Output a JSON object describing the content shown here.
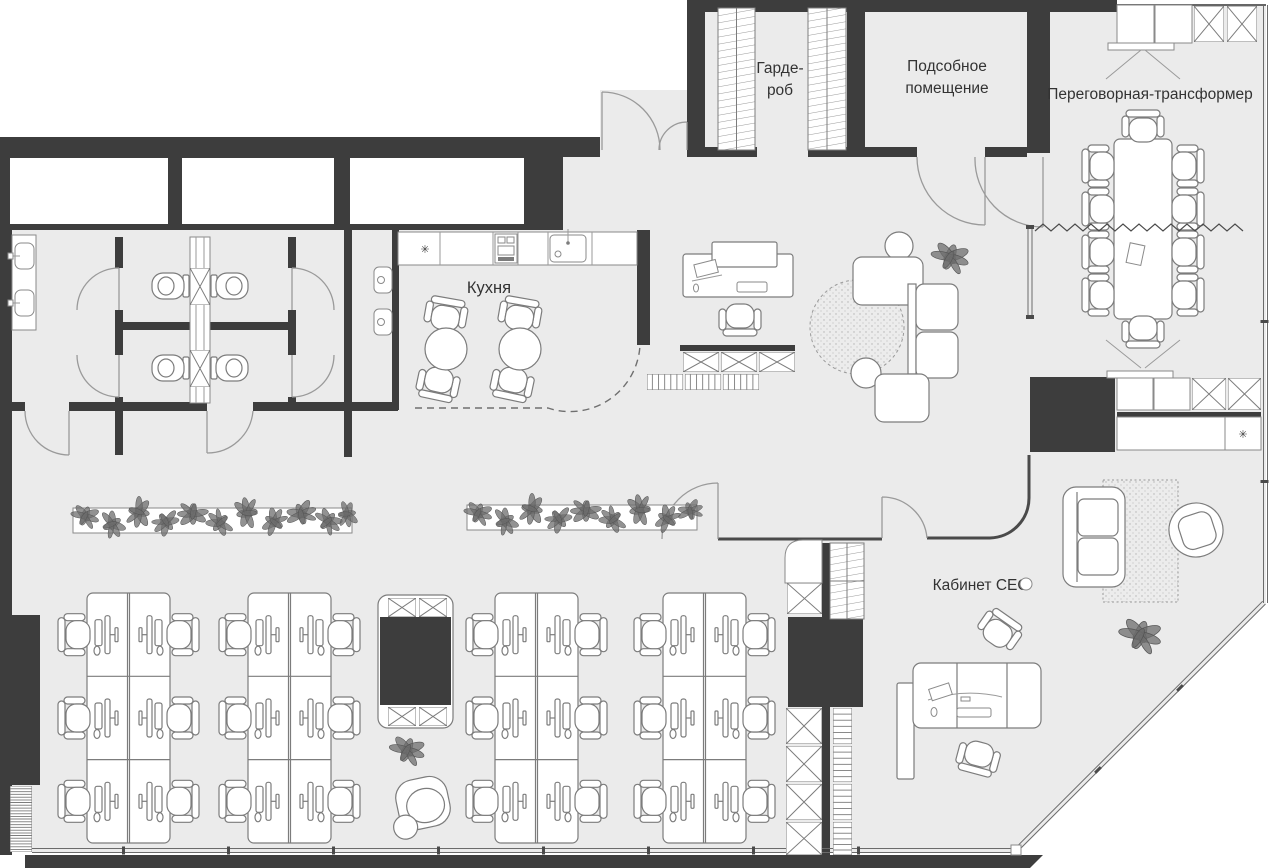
{
  "colors": {
    "floor": "#ebebeb",
    "wall": "#3d3d3d",
    "line": "#7c7c7c",
    "text": "#333333"
  },
  "rooms": {
    "wardrobe": {
      "label_line1": "Гарде-",
      "label_line2": "роб"
    },
    "utility": {
      "label_line1": "Подсобное",
      "label_line2": "помещение"
    },
    "meeting": {
      "label": "Переговорная-трансформер"
    },
    "kitchen": {
      "label": "Кухня"
    },
    "ceo": {
      "label": "Кабинет CEO"
    }
  },
  "symbols": {
    "star": "✳"
  }
}
